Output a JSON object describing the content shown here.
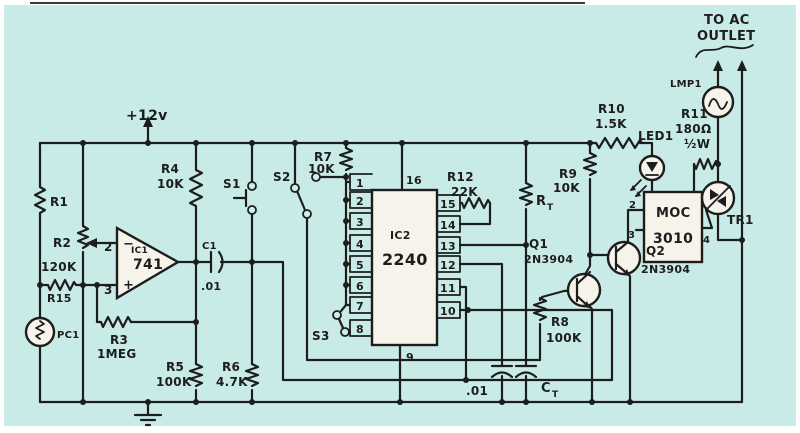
{
  "figure": {
    "type": "hand-drawn circuit schematic (magazine scan)",
    "background_color": "#c9ebe7",
    "ink_color": "#1d1d1d"
  },
  "labels": {
    "supply": "+12v",
    "r1": "R1",
    "r2": "R2",
    "r2_value": "120K",
    "r15": "R15",
    "pc1": "PC1",
    "ic1": "IC1",
    "ic1_part": "741",
    "ic1_pin_inv": "2",
    "ic1_pin_noninv": "3",
    "inv_sign": "−",
    "noninv_sign": "+",
    "r3": "R3",
    "r3_value": "1MEG",
    "r4": "R4",
    "r4_value": "10K",
    "r5": "R5",
    "r5_value": "100K",
    "r6": "R6",
    "r6_value": "4.7K",
    "c1": "C1",
    "c1_value": ".01",
    "s1": "S1",
    "s2": "S2",
    "s3": "S3",
    "r7": "R7",
    "r7_value": "10K",
    "ic2": "IC2",
    "ic2_part": "2240",
    "ic2_pins_left": [
      "1",
      "2",
      "3",
      "4",
      "5",
      "6",
      "7",
      "8"
    ],
    "ic2_pins_right": [
      "15",
      "14",
      "13",
      "12",
      "11",
      "10"
    ],
    "ic2_pin_top": "16",
    "ic2_pin_bottom": "9",
    "r12": "R12",
    "r12_value": "22K",
    "rt_letter": "R",
    "rt_sub": "T",
    "r9": "R9",
    "r9_value": "10K",
    "r10": "R10",
    "r10_value": "1.5K",
    "led1": "LED1",
    "q1": "Q1",
    "q1_part": "2N3904",
    "q2": "Q2",
    "q2_part": "2N3904",
    "r8": "R8",
    "r8_value": "100K",
    "c2_value": ".01",
    "ct_letter": "C",
    "ct_sub": "T",
    "moc_line1": "MOC",
    "moc_line2": "3010",
    "moc_pin2": "2",
    "moc_pin3": "3",
    "moc_pin4": "4",
    "tr1": "TR1",
    "r11": "R11",
    "r11_value": "180Ω",
    "r11_watt": "½W",
    "lmp1": "LMP1",
    "ac_line1": "TO AC",
    "ac_line2": "OUTLET"
  }
}
